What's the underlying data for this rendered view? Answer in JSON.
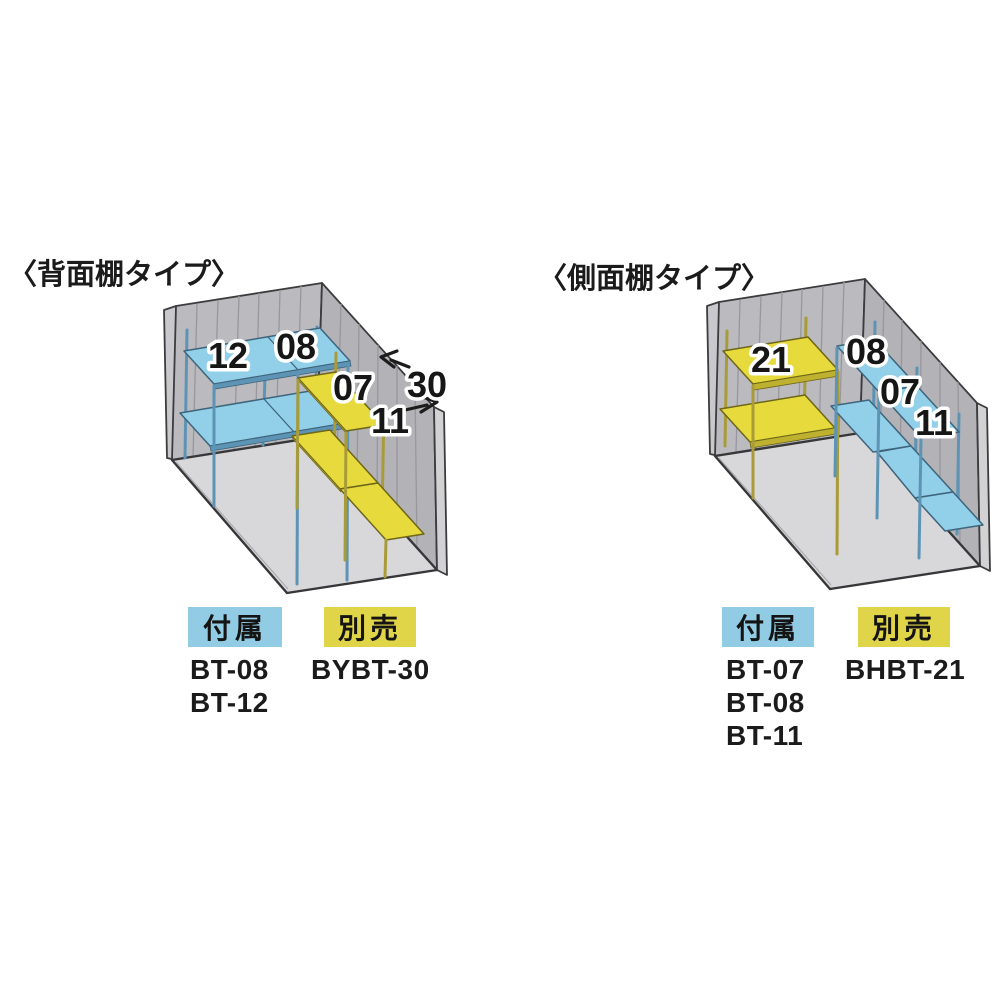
{
  "page": {
    "background": "#ffffff"
  },
  "colors": {
    "shelf_blue": "#92cfe8",
    "shelf_yellow": "#e7da3d",
    "badge_blue": "#92cce4",
    "badge_yellow": "#e0d448",
    "wall_gray": "#bababf",
    "floor_gray": "#d8d8da",
    "outline": "#3c3c3e"
  },
  "diagrams": [
    {
      "title": "〈背面棚タイプ〉",
      "labels": {
        "shelf_12": "12",
        "shelf_08": "08",
        "shelf_07": "07",
        "shelf_11": "11",
        "dim_30": "30"
      },
      "included": {
        "badge": "付属",
        "codes": [
          "BT-08",
          "BT-12"
        ]
      },
      "sold_separately": {
        "badge": "別売",
        "codes": [
          "BYBT-30"
        ]
      }
    },
    {
      "title": "〈側面棚タイプ〉",
      "labels": {
        "shelf_21": "21",
        "shelf_08": "08",
        "shelf_07": "07",
        "shelf_11": "11"
      },
      "included": {
        "badge": "付属",
        "codes": [
          "BT-07",
          "BT-08",
          "BT-11"
        ]
      },
      "sold_separately": {
        "badge": "別売",
        "codes": [
          "BHBT-21"
        ]
      }
    }
  ]
}
